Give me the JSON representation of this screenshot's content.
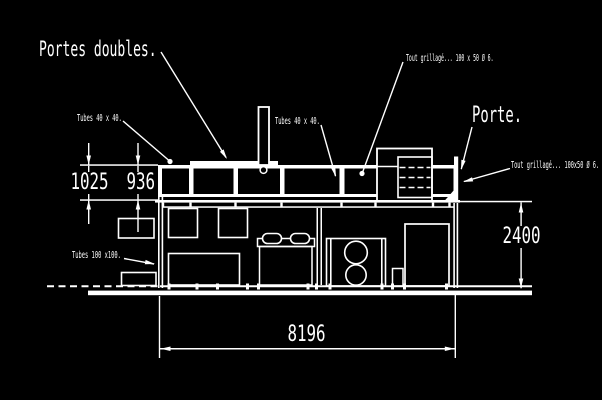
{
  "drawing": {
    "type": "cad-elevation",
    "background_color": "#000000",
    "line_color": "#ffffff",
    "labels": {
      "portes_doubles": "Portes doubles.",
      "tubes_40_left": "Tubes 40 x 40.",
      "tubes_40_mid": "Tubes 40 x 40.",
      "tout_grillage_top": "Tout grillagé... 100 x 50 Ø 6.",
      "porte": "Porte.",
      "tout_grillage_right": "Tout grillagé... 100x50 Ø 6.",
      "tubes_100": "Tubes 100 x100."
    },
    "dimensions": {
      "fence_height_left": "1025",
      "fence_height_mesh": "936",
      "container_height": "2400",
      "container_length": "8196"
    }
  }
}
